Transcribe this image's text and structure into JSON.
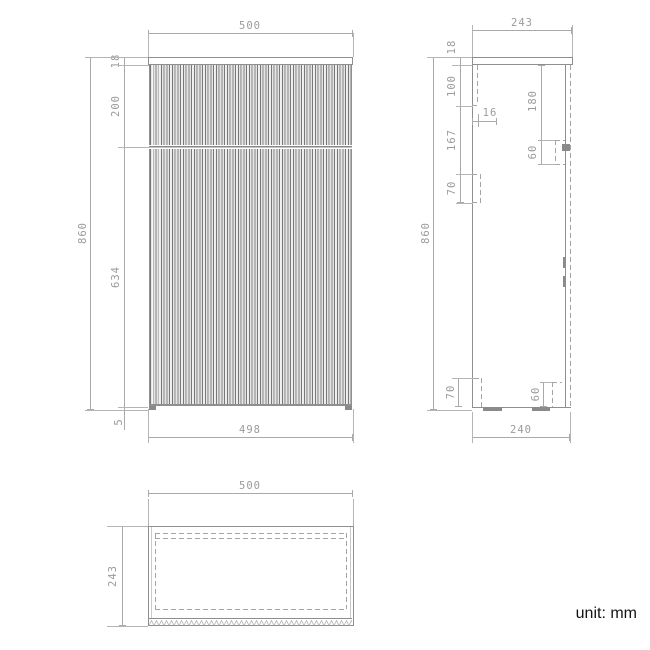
{
  "front": {
    "width_top": "500",
    "height_overall": "860",
    "thickness_top_panel": "18",
    "height_drawer_front": "200",
    "height_door_front": "634",
    "height_foot": "5",
    "width_body": "498"
  },
  "side": {
    "depth_top": "243",
    "thickness_top_panel": "18",
    "offset_drawer_runner": "100",
    "gap_runner_to_hinge": "167",
    "height_hinge_upper": "70",
    "inset_front_panel": "16",
    "offset_wall_bracket": "180",
    "height_wall_bracket": "60",
    "height_overall": "860",
    "height_hinge_lower": "70",
    "height_bracket_lower": "60",
    "depth_body": "240"
  },
  "top": {
    "width": "500",
    "depth": "243"
  },
  "note": {
    "unit": "unit: mm"
  }
}
